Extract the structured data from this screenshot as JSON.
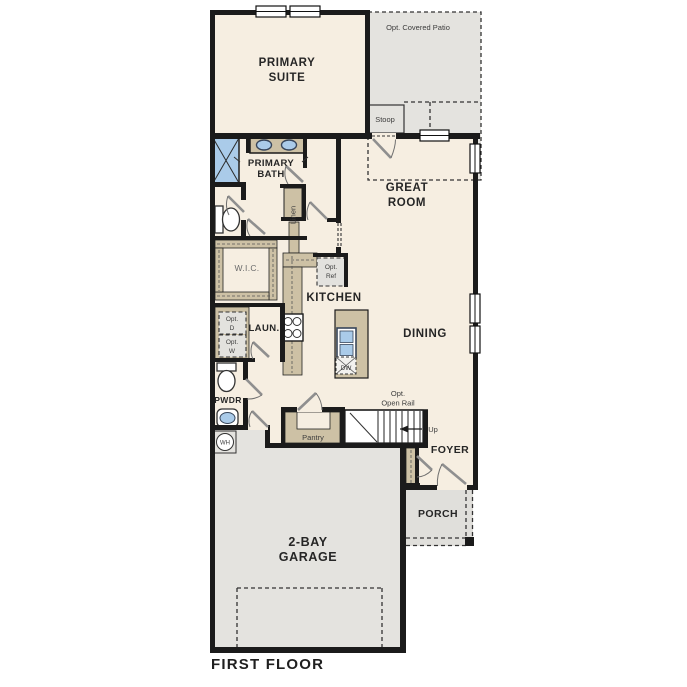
{
  "title": "FIRST FLOOR",
  "rooms": {
    "primary_suite": [
      "PRIMARY",
      "SUITE"
    ],
    "primary_bath": [
      "PRIMARY",
      "BATH"
    ],
    "great_room": [
      "GREAT",
      "ROOM"
    ],
    "kitchen": "KITCHEN",
    "dining": "DINING",
    "wic": "W.I.C.",
    "linen": "Linen",
    "laundry": "LAUN.",
    "powder": "PWDR",
    "pantry": "Pantry",
    "foyer": "FOYER",
    "porch": "PORCH",
    "garage": [
      "2-BAY",
      "GARAGE"
    ],
    "stoop": "Stoop",
    "patio": "Opt. Covered Patio"
  },
  "annotations": {
    "opt_ref": [
      "Opt.",
      "Ref"
    ],
    "opt_dryer": [
      "Opt.",
      "D"
    ],
    "opt_washer": [
      "Opt.",
      "W"
    ],
    "opt_open_rail": [
      "Opt.",
      "Open Rail"
    ],
    "up": "Up",
    "dishwasher": "DW",
    "water_heater": "WH"
  },
  "colors": {
    "wall": "#1b1b1b",
    "room_fill": "#f6eee1",
    "exterior_fill": "#e4e3df",
    "cabinet_fill": "#cdc1a5",
    "fixture_blue": "#aacbe9",
    "option_box_fill": "#e3e2de",
    "background": "#ffffff"
  }
}
